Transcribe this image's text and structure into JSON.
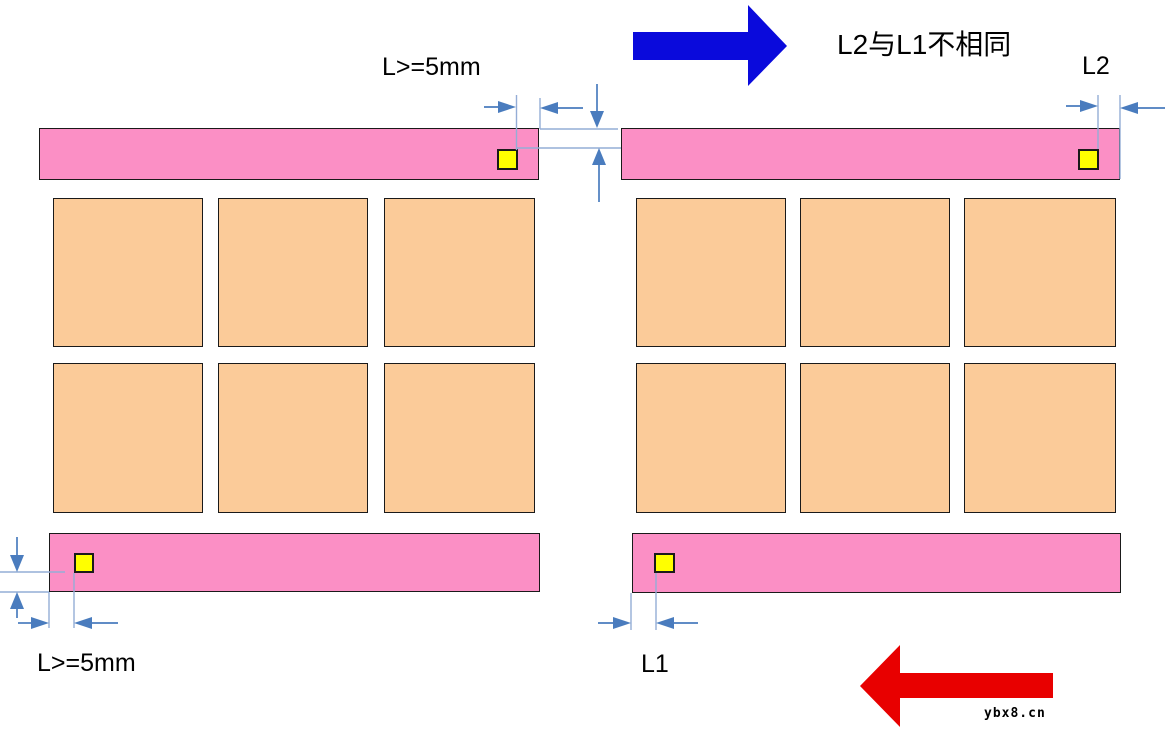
{
  "colors": {
    "background": "#FFFFFF",
    "rail_pink": "#FB8FC5",
    "board_orange": "#FBCB99",
    "fiducial_yellow": "#FFFF00",
    "outline_black": "#1A1A1A",
    "dim_arrow_blue": "#4A7CBE",
    "dim_line_blue": "#94ADD6",
    "direction_arrow_blue": "#0A0ADC",
    "direction_arrow_red": "#E80000"
  },
  "labels": {
    "top_edge_distance": "L>=5mm",
    "l2": "L2",
    "note": "L2与L1不相同",
    "bottom_edge_distance": "L>=5mm",
    "l1": "L1",
    "watermark": "ybx8.cn"
  }
}
